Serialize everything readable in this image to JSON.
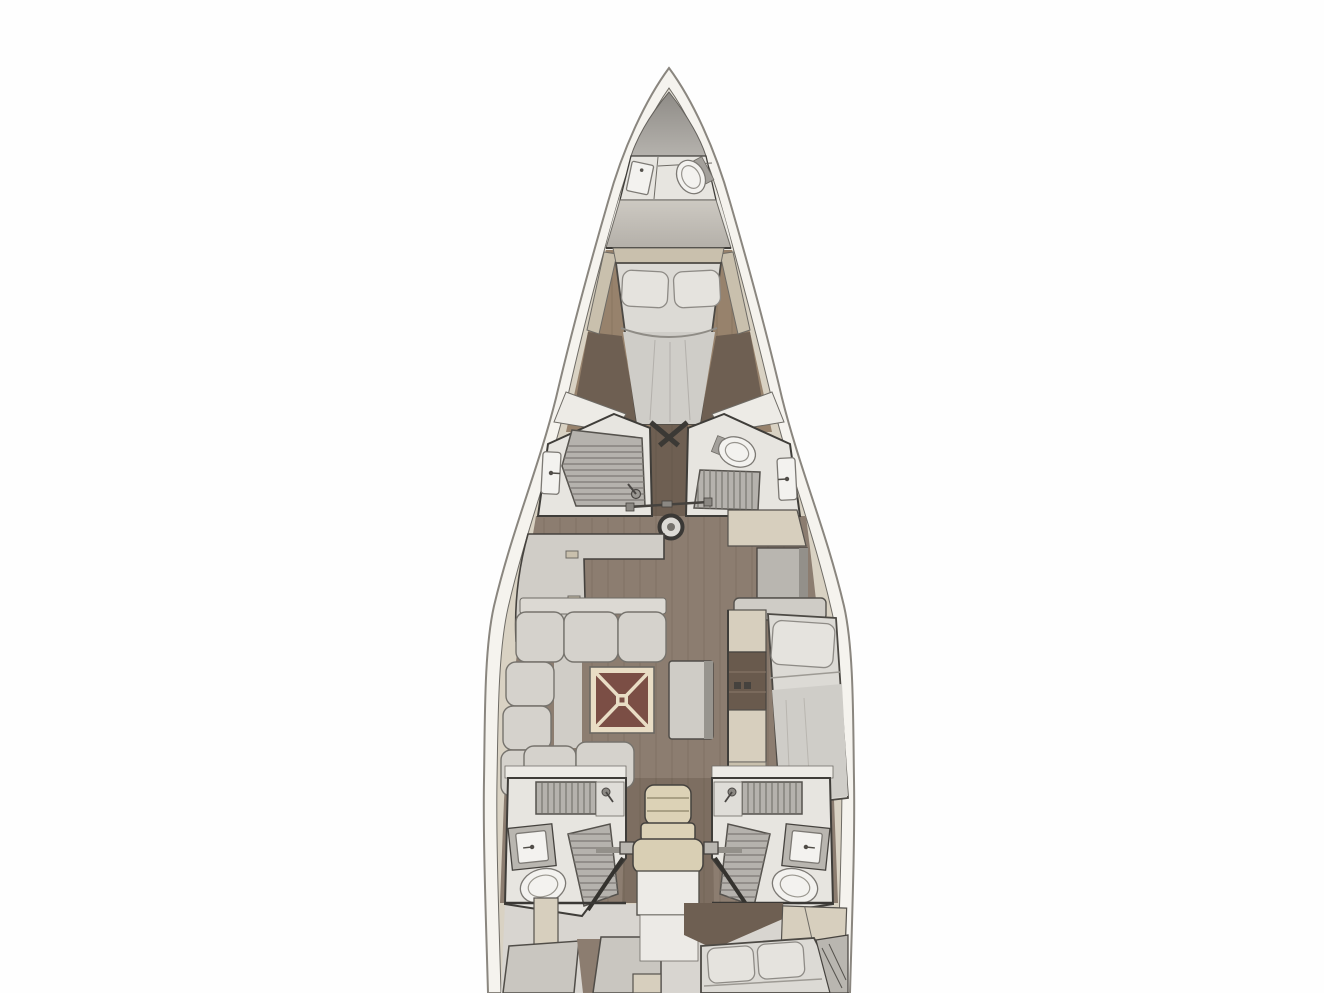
{
  "scene": {
    "label": "Sailing yacht interior layout plan, top-down view, bow at top",
    "type": "boat-deck-plan",
    "view": "top-down",
    "orientation": "bow-up",
    "mast": true,
    "rooms": [
      {
        "id": "anchor-locker",
        "fixtures": []
      },
      {
        "id": "bow-head",
        "fixtures": [
          "sink",
          "toilet"
        ]
      },
      {
        "id": "forward-cabin",
        "fixtures": [
          "double-berth",
          "pillow",
          "pillow",
          "side-shelves"
        ]
      },
      {
        "id": "port-midship-head",
        "fixtures": [
          "shower-tray",
          "sink",
          "shower-fitting"
        ]
      },
      {
        "id": "starboard-midship-head",
        "fixtures": [
          "toilet",
          "shower-grate",
          "sink"
        ]
      },
      {
        "id": "galley",
        "fixtures": [
          "l-shaped-counter",
          "latches"
        ]
      },
      {
        "id": "starboard-cabinets",
        "fixtures": [
          "sideboard",
          "locker",
          "shelf"
        ]
      },
      {
        "id": "salon",
        "fixtures": [
          "u-shaped-sofa",
          "folding-table",
          "bench-seat"
        ]
      },
      {
        "id": "starboard-berth",
        "fixtures": [
          "single-berth",
          "pillow",
          "shelf-column"
        ]
      },
      {
        "id": "port-aft-head",
        "fixtures": [
          "shower",
          "sink",
          "toilet",
          "floor-grate"
        ]
      },
      {
        "id": "starboard-aft-head",
        "fixtures": [
          "shower",
          "sink",
          "toilet",
          "floor-grate"
        ]
      },
      {
        "id": "companionway",
        "fixtures": [
          "steps",
          "handrails",
          "landing"
        ]
      },
      {
        "id": "port-aft-cabin",
        "fixtures": [
          "berth-cushions",
          "locker"
        ]
      },
      {
        "id": "starboard-aft-cabin",
        "fixtures": [
          "double-berth",
          "pillow",
          "pillow",
          "locker"
        ]
      }
    ]
  },
  "palette": {
    "background": "#fefefe",
    "hull": "#f5f3ee",
    "hull_line": "#8a867f",
    "deck": "#d9d2c3",
    "outline": "#3f3d39",
    "outline_soft": "#6e6b65",
    "locker_dark": "#8e8b86",
    "locker_light": "#b5b2ad",
    "bulkhead_top": "#cdc9c2",
    "bulkhead_bottom": "#b4b0a9",
    "room_floor": "#e7e5e0",
    "fixture": "#f3f2ef",
    "slat": "#b5b2ad",
    "slat_line": "#7d7a75",
    "wood": "#8c7d70",
    "wood_light": "#97826c",
    "wood_dark": "#6e5f52",
    "wood_plank": "#4a3c30",
    "counter": "#d0cdc7",
    "cabinet_gray": "#b9b6b0",
    "cabinet_dark": "#93908a",
    "beige": "#d7cfbe",
    "beige_dark": "#c9c0ad",
    "sofa": "#d5d2cc",
    "sofa_line": "#76736d",
    "mattress": "#dcdad5",
    "mattress_shade": "#cfcdc8",
    "pillow": "#e5e3de",
    "table_frame": "#e9ddc5",
    "table_top": "#7b4e45",
    "bench": "#cfccc6",
    "bench_dark": "#97948e",
    "step": "#dcd2b6",
    "landing": "#edebe7",
    "aft_base": "#d8d5d0",
    "white_top": "#edebe6",
    "shelf_dark": "#695a4d"
  }
}
